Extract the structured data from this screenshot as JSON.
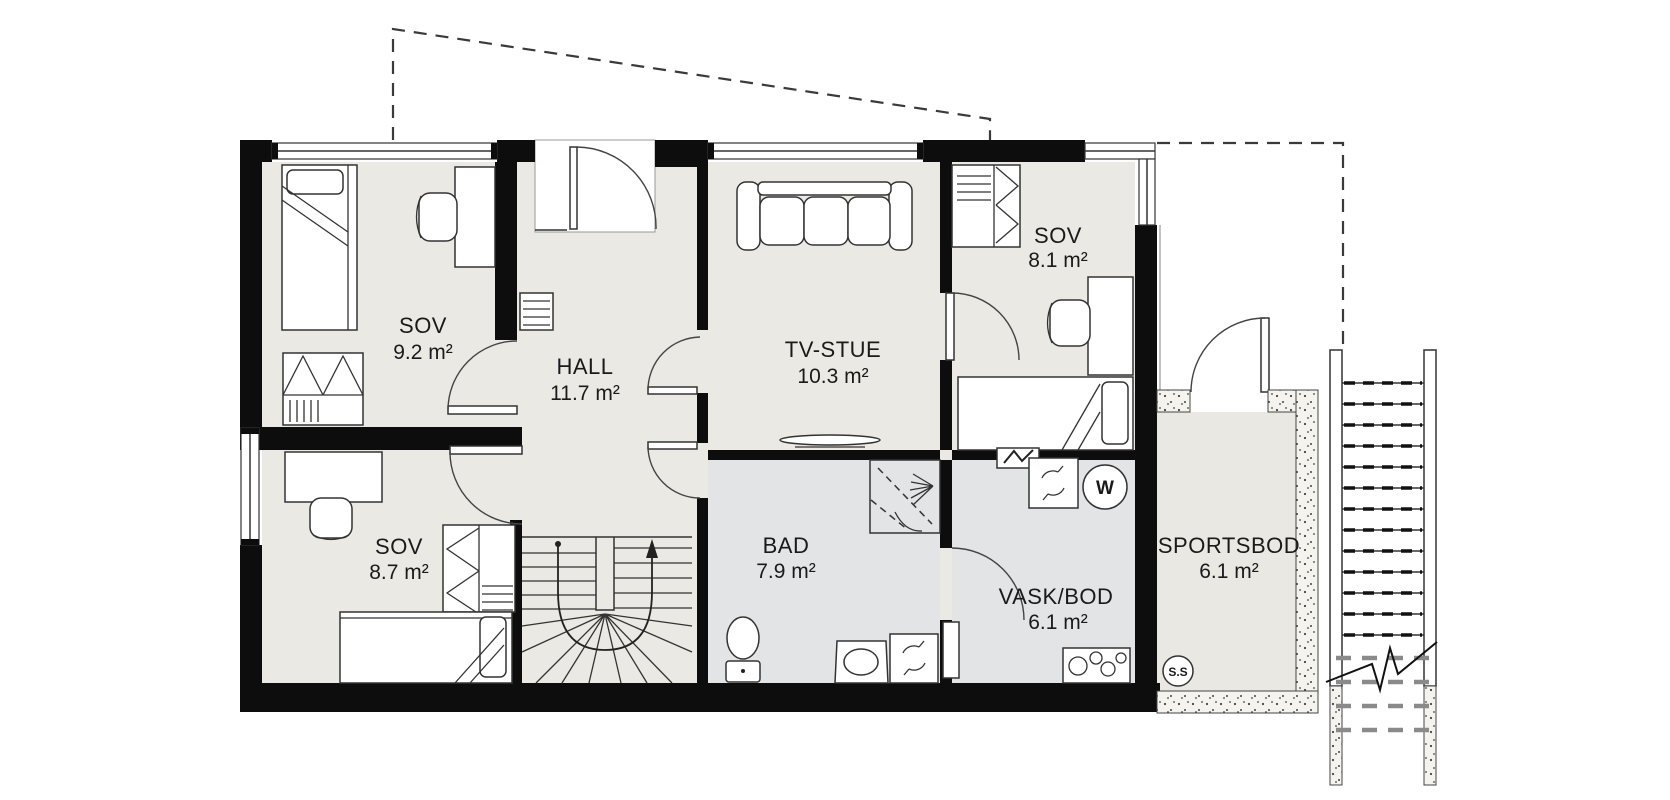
{
  "plan": {
    "rooms": [
      {
        "name": "SOV",
        "area": "9.2 m²"
      },
      {
        "name": "HALL",
        "area": "11.7 m²"
      },
      {
        "name": "TV-STUE",
        "area": "10.3 m²"
      },
      {
        "name": "SOV",
        "area": "8.1 m²"
      },
      {
        "name": "SOV",
        "area": "8.7 m²"
      },
      {
        "name": "BAD",
        "area": "7.9 m²"
      },
      {
        "name": "VASK/BOD",
        "area": "6.1 m²"
      },
      {
        "name": "SPORTSBOD",
        "area": "6.1 m²"
      }
    ],
    "markers": {
      "water_heater": "W",
      "sports_storage": "S.S"
    },
    "colors": {
      "wall": "#0d0d0d",
      "floor": "#eae9e3",
      "wet_room_floor": "#e3e4e6",
      "storage_floor": "#e9e8e2"
    }
  }
}
